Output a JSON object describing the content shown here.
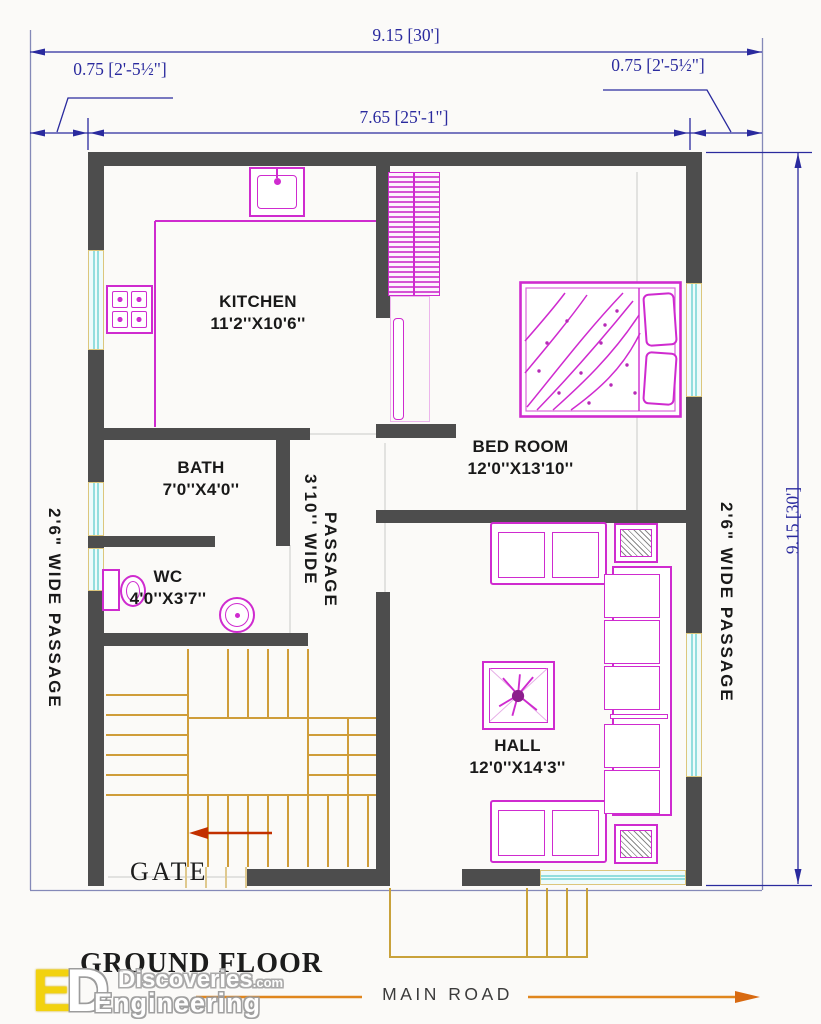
{
  "dimensions": {
    "overall_width": "9.15 [30']",
    "inner_width": "7.65 [25'-1\"]",
    "left_offset": "0.75 [2'-5½\"]",
    "right_offset": "0.75 [2'-5½\"]",
    "overall_depth": "9.15 [30']"
  },
  "rooms": [
    {
      "name": "KITCHEN",
      "size": "11'2''X10'6''"
    },
    {
      "name": "BATH",
      "size": "7'0''X4'0''"
    },
    {
      "name": "WC",
      "size": "4'0''X3'7''"
    },
    {
      "name": "BED ROOM",
      "size": "12'0''X13'10''"
    },
    {
      "name": "HALL",
      "size": "12'0''X14'3''"
    }
  ],
  "passages": {
    "left": "2'6\" WIDE PASSAGE",
    "right": "2'6\" WIDE PASSAGE",
    "center_line1": "3'10'' WIDE",
    "center_line2": "PASSAGE"
  },
  "labels": {
    "gate": "GATE",
    "ground_floor": "GROUND FLOOR",
    "main_road": "MAIN  ROAD"
  },
  "branding": {
    "logo_e": "E",
    "logo_d": "D",
    "name": "Engineering",
    "site": "Discoveries",
    "tld": ".com"
  },
  "colors": {
    "wall": "#4d4d4d",
    "furniture": "#cf2bcf",
    "stairs": "#cf9d3a",
    "dimensions": "#2a2a9e",
    "window_glass": "#effbfb",
    "window_frame": "#dcc67c",
    "road": "#e0861e",
    "stair_arrow": "#c23000"
  }
}
